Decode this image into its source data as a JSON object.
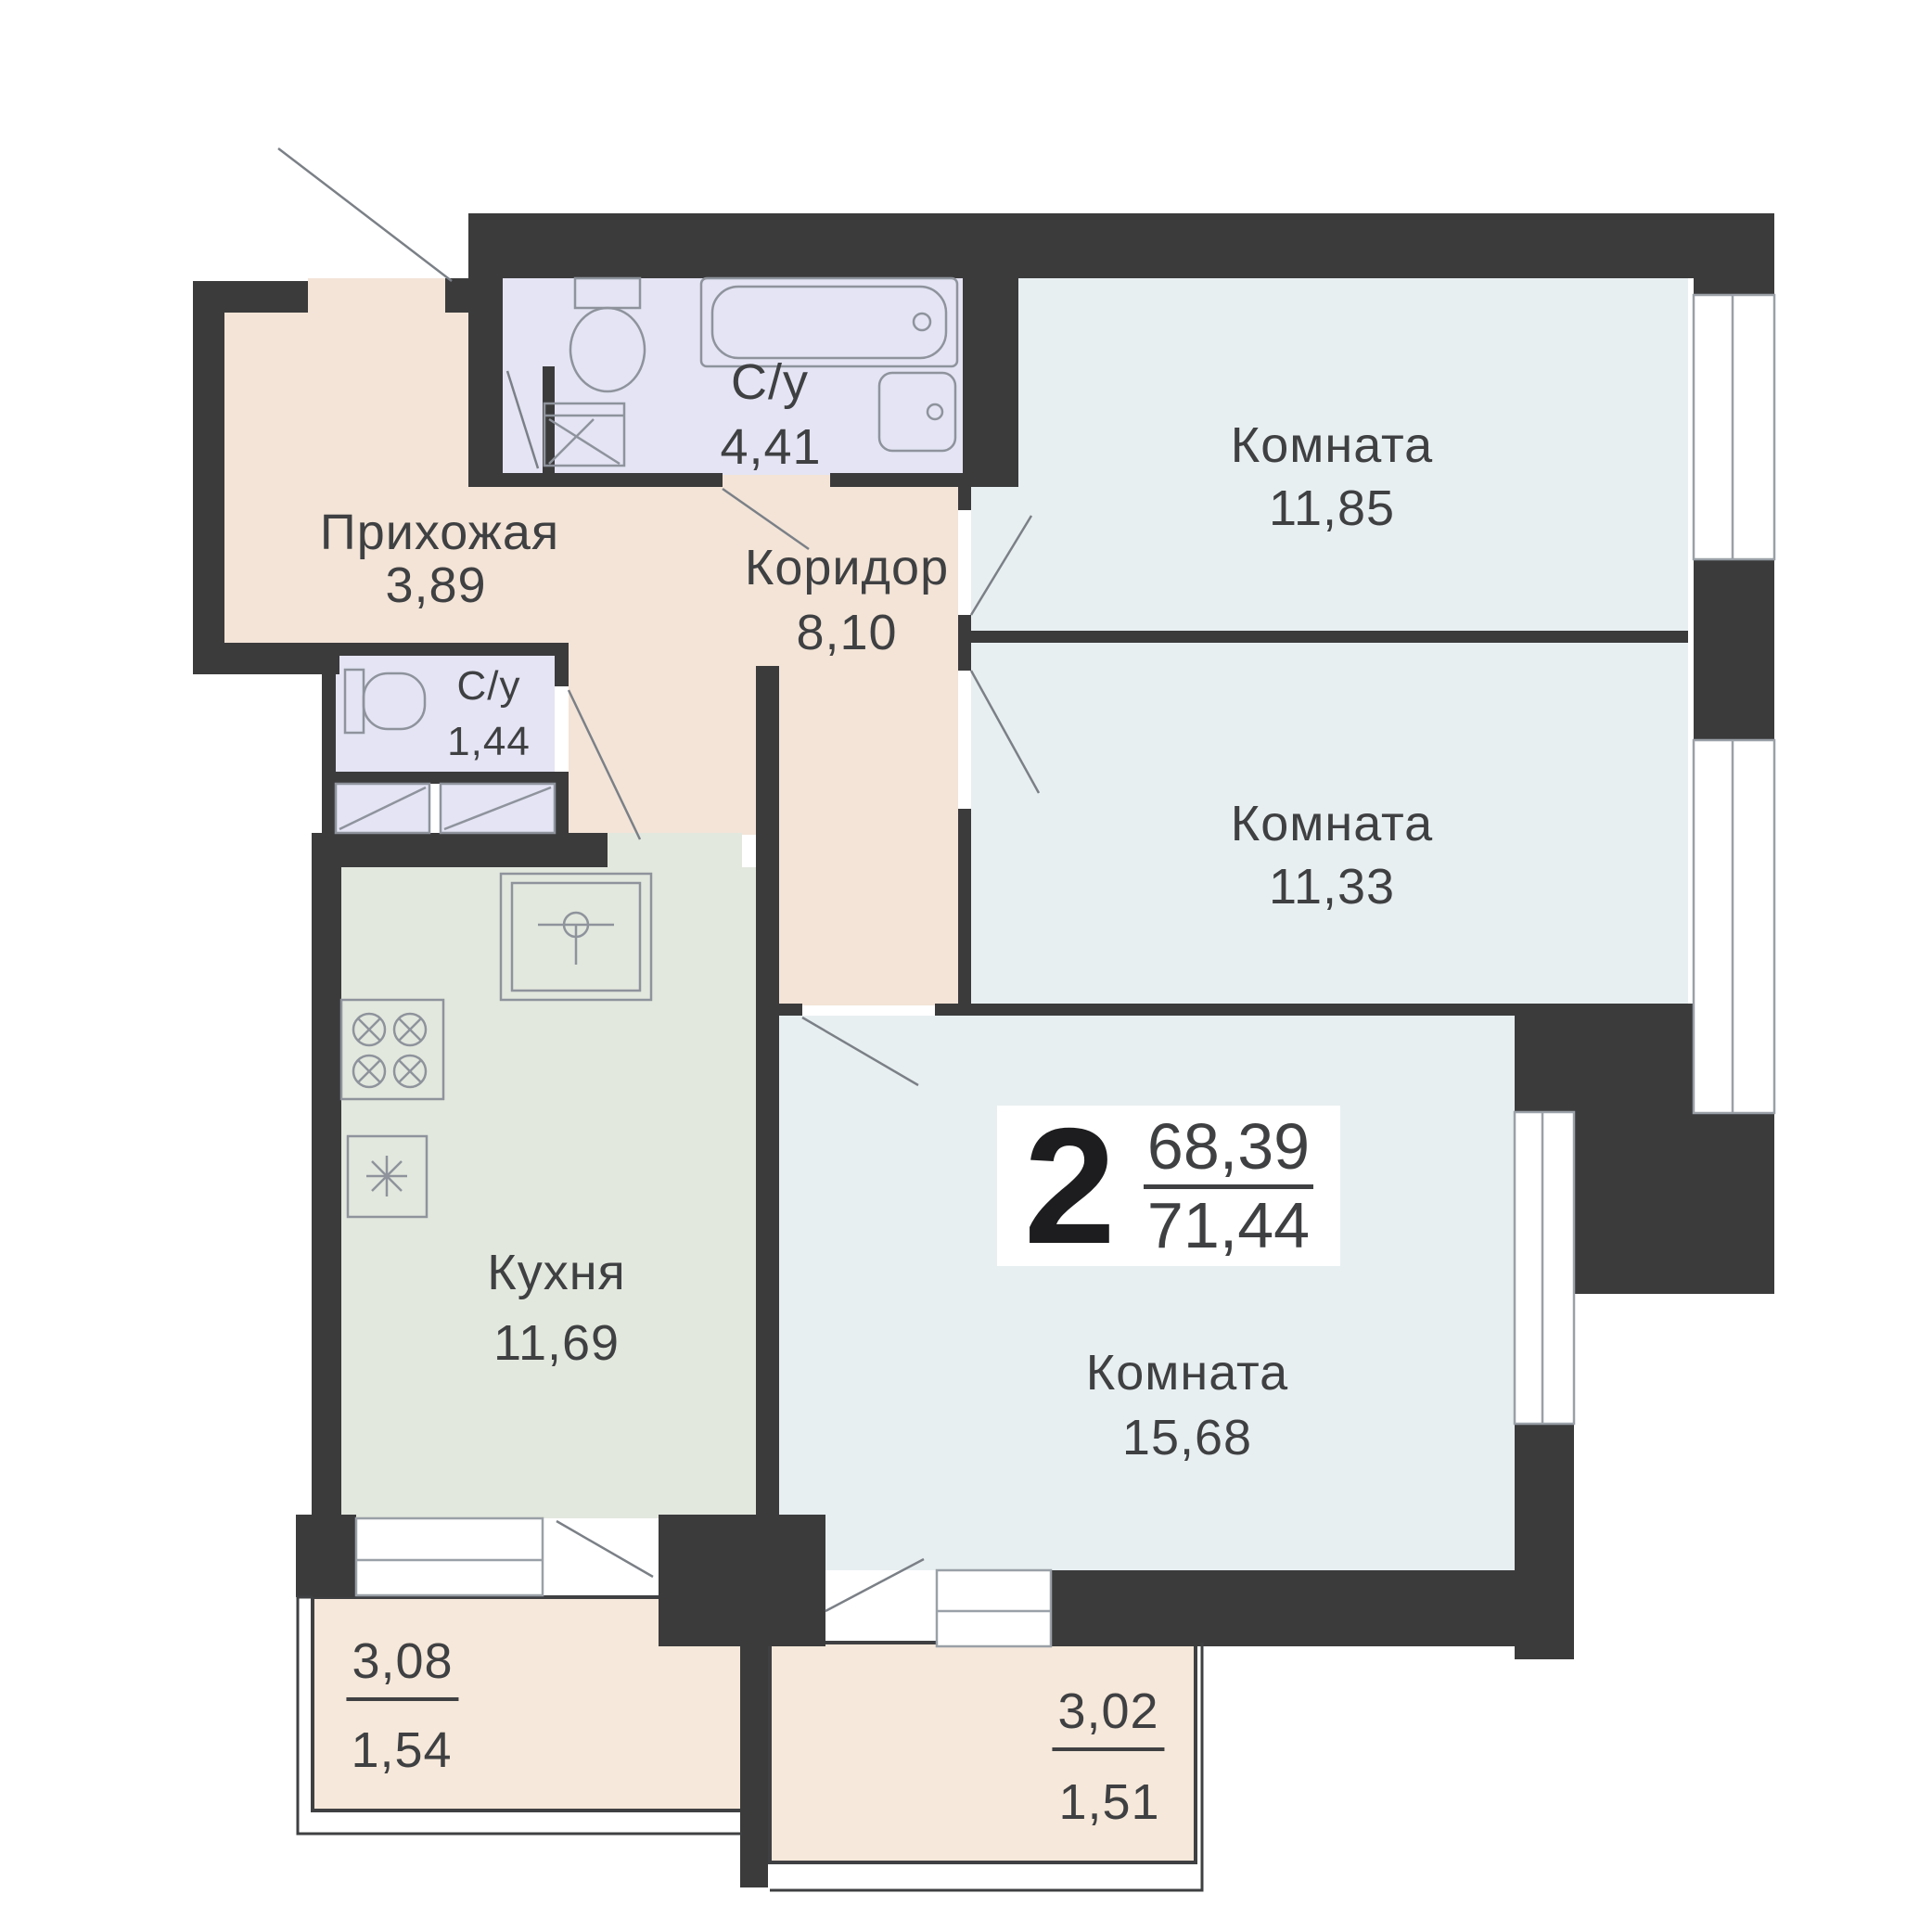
{
  "plan": {
    "title": "2-room apartment floor plan",
    "summary": {
      "rooms_count": "2",
      "area_living": "68,39",
      "area_total": "71,44"
    },
    "rooms": [
      {
        "id": "hallway",
        "name": "Прихожая",
        "area": "3,89"
      },
      {
        "id": "bathroom",
        "name": "С/у",
        "area": "4,41"
      },
      {
        "id": "corridor",
        "name": "Коридор",
        "area": "8,10"
      },
      {
        "id": "room1",
        "name": "Комната",
        "area": "11,85"
      },
      {
        "id": "room2",
        "name": "Комната",
        "area": "11,33"
      },
      {
        "id": "wc",
        "name": "С/у",
        "area": "1,44"
      },
      {
        "id": "kitchen",
        "name": "Кухня",
        "area": "11,69"
      },
      {
        "id": "room3",
        "name": "Комната",
        "area": "15,68"
      }
    ],
    "balconies": [
      {
        "id": "balcony-left",
        "area": "3,08",
        "area_reduced": "1,54"
      },
      {
        "id": "balcony-right",
        "area": "3,02",
        "area_reduced": "1,51"
      }
    ],
    "fixtures": [
      "bathtub",
      "toilet",
      "sink",
      "washing-machine",
      "closet",
      "kitchen-sink",
      "stove",
      "fridge",
      "vent-shaft"
    ],
    "colors": {
      "wall": "#3b3b3c",
      "hall_fill": "#f3e4d7",
      "bath_fill": "#e4e4f4",
      "room_fill": "#e8eff1",
      "kitchen_fill": "#e3e8de",
      "balcony_fill": "#f6e8da",
      "text": "#3f4042",
      "fixture_line": "#8e939c",
      "window_line": "#9aa0a7"
    }
  }
}
